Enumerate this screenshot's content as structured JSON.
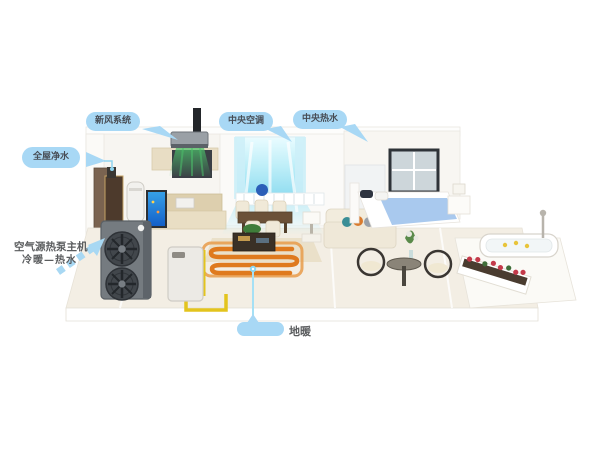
{
  "callouts": {
    "fresh_air": "新风系统",
    "central_ac": "中央空调",
    "central_hot_water": "中央热水",
    "water_purification": "全屋净水",
    "heat_pump_title": "空气源热泵主机",
    "heat_pump_subtitle": "冷暖—热水",
    "floor_heating": "地暖"
  },
  "colors": {
    "callout_bg": "#a8d8f5",
    "callout_text": "#474c54",
    "connector_blue": "#9fdcf4",
    "fresh_air_beam": "#4cc06a",
    "cool_air_glow": "#aee8f6",
    "floor_heating_coil": "#df7a1e",
    "water_pipe": "#e3c41d",
    "heat_pump_body": "#757b80",
    "aquarium_blue": "#1f6fd4",
    "bed_blanket": "#a9c9ee",
    "flower_red": "#c43a4a",
    "background": "#ffffff"
  }
}
